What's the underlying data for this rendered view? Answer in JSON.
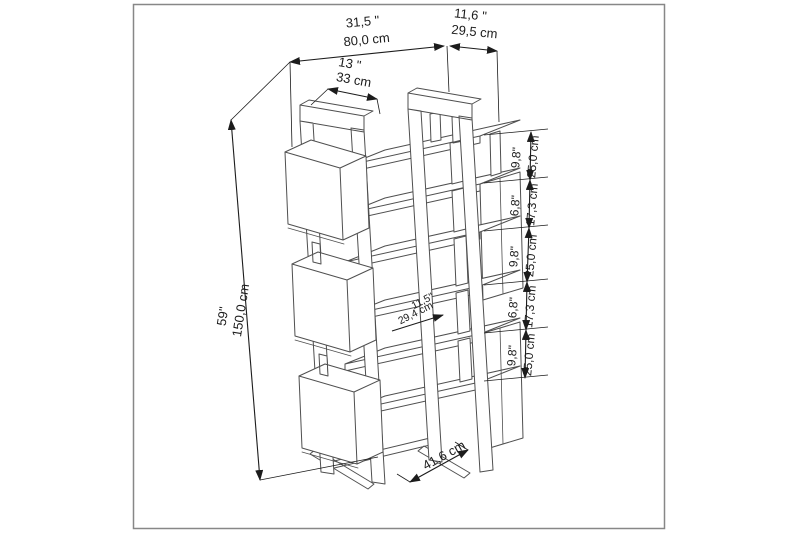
{
  "diagram": {
    "type": "furniture-dimension-drawing",
    "subject": "bookshelf"
  },
  "colors": {
    "line": "#4f4f4f",
    "dimension": "#1c1c1c",
    "panel_border": "#878787",
    "panel_bg": "#ffffff"
  },
  "dimensions": {
    "top_width": {
      "inches": "31,5 \"",
      "cm": "80,0 cm"
    },
    "top_depth": {
      "inches": "11,6 \"",
      "cm": "29,5 cm"
    },
    "top_shelf": {
      "inches": "13 \"",
      "cm": "33 cm"
    },
    "height": {
      "inches": "59\"",
      "cm": "150,0 cm"
    },
    "right_segments": [
      {
        "inches": "9,8\"",
        "cm": "25,0 cm"
      },
      {
        "inches": "6,8\"",
        "cm": "17,3 cm"
      },
      {
        "inches": "9,8\"",
        "cm": "25,0 cm"
      },
      {
        "inches": "6,8\"",
        "cm": "17,3 cm"
      },
      {
        "inches": "9,8\"",
        "cm": "25,0 cm"
      }
    ],
    "shelf_depth": {
      "inches": "11,5\"",
      "cm": "29,4 cm"
    },
    "base_diagonal": {
      "cm": "41,6 cm"
    }
  }
}
